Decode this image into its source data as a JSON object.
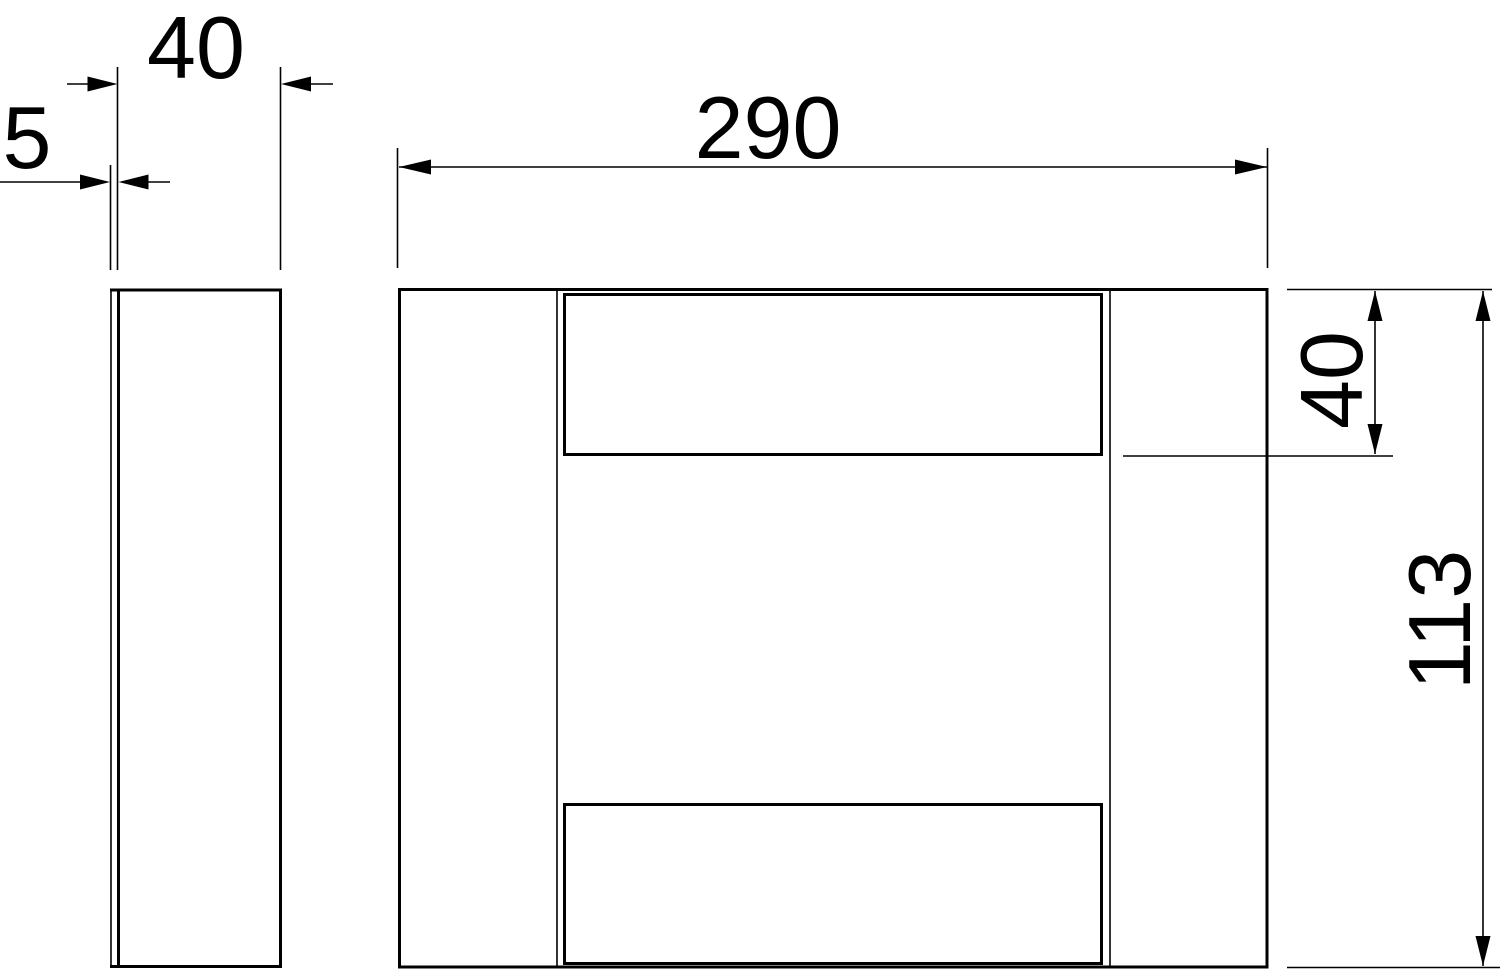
{
  "drawing": {
    "kind": "technical-dimension-drawing",
    "colors": {
      "line": "#000000",
      "background": "#ffffff"
    },
    "views": [
      {
        "id": "side-view",
        "description": "narrow side profile with panel line"
      },
      {
        "id": "front-view",
        "description": "front face with top and bottom recessed panels"
      }
    ]
  },
  "dimensions": {
    "side_depth": "40",
    "side_panel_thickness": "5",
    "front_width": "290",
    "front_top_section_height": "40",
    "front_total_height": "113"
  }
}
